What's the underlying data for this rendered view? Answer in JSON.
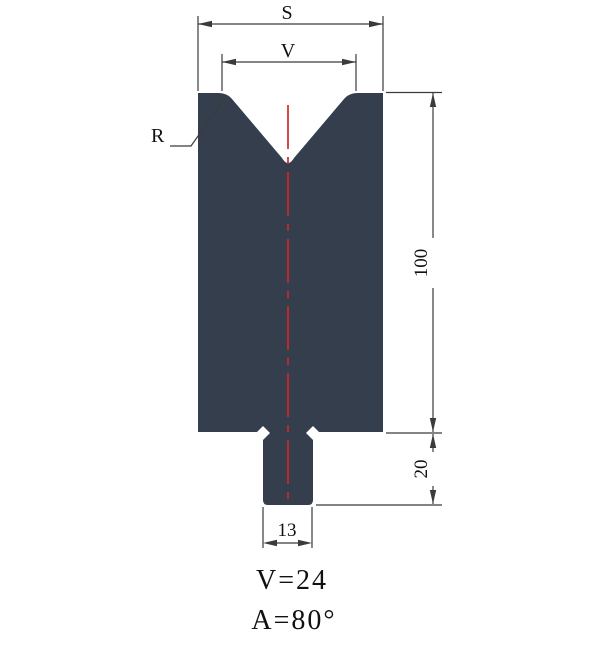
{
  "figure": {
    "labels": {
      "top_width": "S",
      "groove_width": "V",
      "radius": "R"
    },
    "dimensions": {
      "body_height": "100",
      "tang_height": "20",
      "tang_width": "13"
    },
    "annotations": {
      "v_value": "V=24",
      "angle_value": "A=80°"
    },
    "colors": {
      "body": "#343e4d",
      "centerline": "#d2262b",
      "dimension_lines": "#3b3b3b",
      "text": "#111111",
      "background": "#ffffff"
    }
  }
}
